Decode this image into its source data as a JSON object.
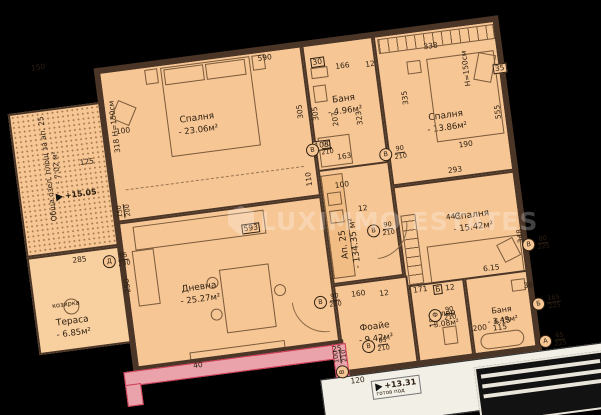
{
  "watermark": {
    "text": "LUXIMMO ESTATES"
  },
  "apartment": {
    "label": "Ап. 25",
    "area": "- 134.35 м²"
  },
  "rooms": {
    "bedroom1": {
      "name": "Спалня",
      "area": "- 23.06м²"
    },
    "bath1": {
      "name": "Баня",
      "area": "- 4.96м²"
    },
    "bedroom2": {
      "name": "Спалня",
      "area": "- 13.86м²"
    },
    "bedroom3": {
      "name": "Спалня",
      "area": "- 15.42м²"
    },
    "living": {
      "name": "Дневна",
      "area": "- 25.27м²"
    },
    "foyer": {
      "name": "Фоайе",
      "area": "- 9.42м²"
    },
    "closet": {
      "name": "Килер",
      "area": "- 3.08м²"
    },
    "bath2": {
      "name": "Баня",
      "area": "- 3.49м²"
    },
    "terrace": {
      "name": "Тераса",
      "area": "- 6.85м²"
    },
    "green": {
      "name": "Обща озел.",
      "line2": "площ за ап. 25",
      "area": "- 7.02 м²"
    }
  },
  "heights": {
    "left": "318 H=150см",
    "right": "H=150см"
  },
  "elevations": {
    "terrace_level": "+15.05",
    "floor_level": "+13.31",
    "floor_note": "готов под"
  },
  "notes": [
    {
      "t": "козирка",
      "x": -76,
      "y": 222
    }
  ],
  "dimensions": [
    {
      "t": "150",
      "x": -66,
      "y": -16
    },
    {
      "t": "590",
      "x": 160,
      "y": 4
    },
    {
      "t": "100",
      "x": 10,
      "y": 58
    },
    {
      "t": "305",
      "x": 188,
      "y": 62,
      "r": 1
    },
    {
      "t": "110",
      "x": 188,
      "y": 130,
      "r": 1
    },
    {
      "t": "30",
      "x": 212,
      "y": 14,
      "b": 1
    },
    {
      "t": "166",
      "x": 236,
      "y": 22
    },
    {
      "t": "12",
      "x": 266,
      "y": 24
    },
    {
      "t": "338",
      "x": 326,
      "y": 14
    },
    {
      "t": "35",
      "x": 392,
      "y": 44,
      "b": 1
    },
    {
      "t": "305",
      "x": 203,
      "y": 66,
      "r": 1
    },
    {
      "t": "207",
      "x": 222,
      "y": 74,
      "r": 1
    },
    {
      "t": "323",
      "x": 246,
      "y": 76,
      "r": 1
    },
    {
      "t": "335",
      "x": 294,
      "y": 62,
      "r": 1
    },
    {
      "t": "555",
      "x": 384,
      "y": 88,
      "r": 1
    },
    {
      "t": "190",
      "x": 348,
      "y": 116
    },
    {
      "t": "293",
      "x": 334,
      "y": 140
    },
    {
      "t": "163",
      "x": 226,
      "y": 112
    },
    {
      "t": "103",
      "x": 203,
      "y": 97,
      "b": 1
    },
    {
      "t": "100",
      "x": 220,
      "y": 140
    },
    {
      "t": "12",
      "x": 240,
      "y": 166
    },
    {
      "t": "443",
      "x": 326,
      "y": 186
    },
    {
      "t": "348",
      "x": 390,
      "y": 214,
      "r": 1
    },
    {
      "t": "593",
      "x": 122,
      "y": 170,
      "b": 1
    },
    {
      "t": "125",
      "x": -30,
      "y": 84
    },
    {
      "t": "285",
      "x": -50,
      "y": 180
    },
    {
      "t": "250",
      "x": -6,
      "y": 212,
      "r": 1
    },
    {
      "t": "160",
      "x": 222,
      "y": 250
    },
    {
      "t": "12",
      "x": 250,
      "y": 253
    },
    {
      "t": "171",
      "x": 284,
      "y": 254
    },
    {
      "t": "Б",
      "x": 304,
      "y": 255,
      "b": 1
    },
    {
      "t": "12",
      "x": 316,
      "y": 256
    },
    {
      "t": "180",
      "x": 292,
      "y": 286,
      "r": 1
    },
    {
      "t": "120",
      "x": 210,
      "y": 336
    },
    {
      "t": "200",
      "x": 338,
      "y": 300
    },
    {
      "t": "115",
      "x": 358,
      "y": 302
    },
    {
      "t": "40",
      "x": 56,
      "y": 300
    },
    {
      "t": "25",
      "x": 196,
      "y": 302
    },
    {
      "t": "6.15",
      "x": 356,
      "y": 242
    },
    {
      "t": "6.15",
      "x": 360,
      "y": 296
    },
    {
      "t": "36",
      "x": 394,
      "y": 264
    }
  ],
  "openings": [
    {
      "l": "В",
      "s": "90/210",
      "x": 196,
      "y": 98
    },
    {
      "l": "В",
      "s": "90/210",
      "x": 268,
      "y": 112
    },
    {
      "l": "В",
      "s": "90/210",
      "x": 246,
      "y": 186
    },
    {
      "l": "В",
      "s": "90/210",
      "x": 184,
      "y": 250
    },
    {
      "l": "В",
      "s": "85/210",
      "x": 226,
      "y": 300
    },
    {
      "l": "Ф",
      "s": "90/210",
      "x": 296,
      "y": 278
    },
    {
      "l": "Д",
      "s": "85/230",
      "x": -20,
      "y": 182
    },
    {
      "l": "В",
      "s": "100/210",
      "x": 188,
      "y": 314,
      "r": 1
    },
    {
      "s": "150/200",
      "x": 0,
      "y": 134,
      "r": 1
    },
    {
      "l": "В",
      "s": "80/225",
      "x": 398,
      "y": 220
    },
    {
      "l": "Б",
      "s": "165/225",
      "x": 400,
      "y": 280
    },
    {
      "l": "А",
      "s": "65/225",
      "x": 402,
      "y": 318
    }
  ]
}
